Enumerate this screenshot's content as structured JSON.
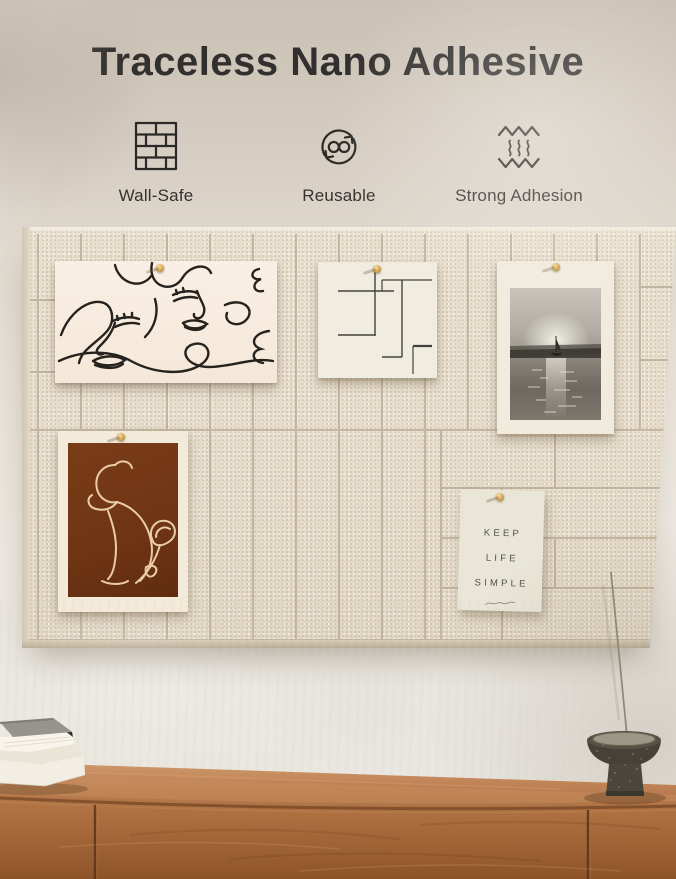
{
  "header": {
    "title": "Traceless Nano Adhesive",
    "features": [
      {
        "icon": "brick-wall-icon",
        "label": "Wall-Safe"
      },
      {
        "icon": "reuse-cycle-icon",
        "label": "Reusable"
      },
      {
        "icon": "adhesion-waves-icon",
        "label": "Strong Adhesion"
      }
    ]
  },
  "board": {
    "quote_card": {
      "lines": [
        "KEEP",
        "LIFE",
        "SIMPLE"
      ]
    }
  },
  "colors": {
    "header_background": "#cbc2b6",
    "wall": "#ebe8e2",
    "felt_board": "#e5dccb",
    "felt_seam": "#b7a890",
    "wood_top": "#c08457",
    "wood_front": "#a4683a",
    "terracotta": "#6f3514",
    "pin_gold": "#d2a855",
    "title_text": "#32302e"
  }
}
